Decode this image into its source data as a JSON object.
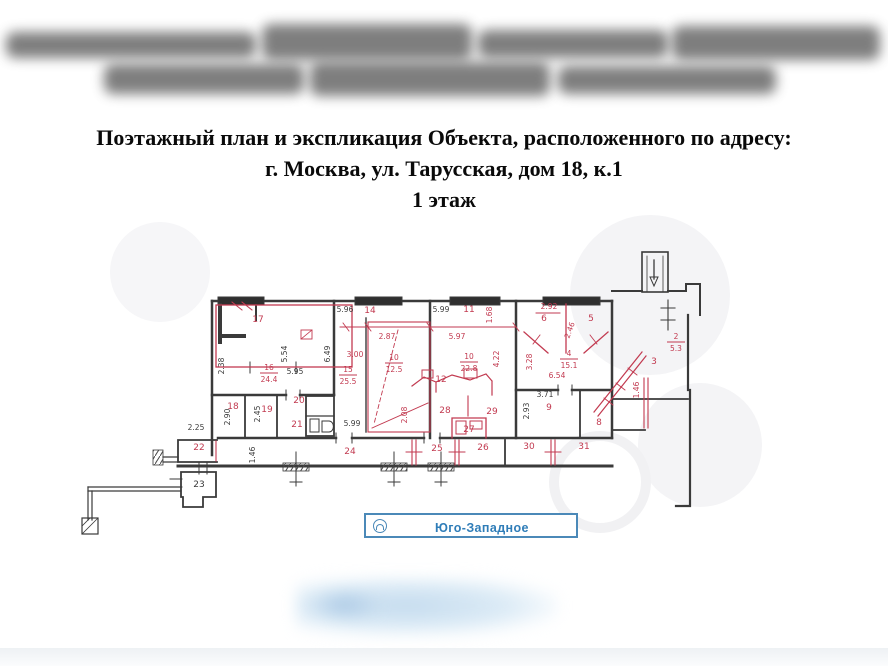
{
  "header": {
    "line1": "Поэтажный план и экспликация Объекта, расположенного по адресу:",
    "line2": "г. Москва, ул. Тарусская, дом 18, к.1",
    "line3": "1 этаж"
  },
  "stamp": {
    "label": "Юго-Западное"
  },
  "plan": {
    "colors": {
      "wall": "#3a3a3a",
      "red": "#c23a50"
    },
    "dims_black": [
      {
        "t": "5.96",
        "x": 345,
        "y": 312
      },
      {
        "t": "5.99",
        "x": 441,
        "y": 312
      },
      {
        "t": "5.54",
        "x": 287,
        "y": 354,
        "v": 1
      },
      {
        "t": "6.49",
        "x": 330,
        "y": 354,
        "v": 1
      },
      {
        "t": "2.38",
        "x": 224,
        "y": 366,
        "v": 1
      },
      {
        "t": "5.95",
        "x": 295,
        "y": 374
      },
      {
        "t": "2.90",
        "x": 230,
        "y": 417,
        "v": 1
      },
      {
        "t": "2.45",
        "x": 260,
        "y": 414,
        "v": 1
      },
      {
        "t": "5.99",
        "x": 352,
        "y": 426
      },
      {
        "t": "2.25",
        "x": 196,
        "y": 430
      },
      {
        "t": "1.46",
        "x": 255,
        "y": 455,
        "v": 1
      },
      {
        "t": "23",
        "x": 199,
        "y": 487,
        "fs": 9
      },
      {
        "t": "3.71",
        "x": 545,
        "y": 397
      },
      {
        "t": "2.93",
        "x": 529,
        "y": 411,
        "v": 1
      }
    ],
    "labels_red": [
      {
        "t": "17",
        "x": 258,
        "y": 322
      },
      {
        "t": "14",
        "x": 370,
        "y": 313
      },
      {
        "t": "11",
        "x": 469,
        "y": 312
      },
      {
        "t": "1.68",
        "x": 492,
        "y": 315,
        "v": 1
      },
      {
        "t": "2.87",
        "x": 387,
        "y": 339
      },
      {
        "t": "3.00",
        "x": 355,
        "y": 357
      },
      {
        "t": "5.97",
        "x": 457,
        "y": 339
      },
      {
        "t": "4.22",
        "x": 499,
        "y": 359,
        "v": 1
      },
      {
        "t": "12",
        "x": 441,
        "y": 382
      },
      {
        "t": "2.92",
        "x": 549,
        "y": 309
      },
      {
        "t": "6",
        "x": 544,
        "y": 321
      },
      {
        "t": "5",
        "x": 591,
        "y": 321
      },
      {
        "t": "2.46",
        "x": 572,
        "y": 331,
        "rot": -70
      },
      {
        "t": "3.28",
        "x": 532,
        "y": 362,
        "v": 1
      },
      {
        "t": "6.54",
        "x": 557,
        "y": 378
      },
      {
        "t": "3",
        "x": 654,
        "y": 364
      },
      {
        "t": "1.46",
        "x": 639,
        "y": 390,
        "v": 1
      },
      {
        "t": "18",
        "x": 233,
        "y": 409
      },
      {
        "t": "19",
        "x": 267,
        "y": 412
      },
      {
        "t": "20",
        "x": 299,
        "y": 403
      },
      {
        "t": "21",
        "x": 297,
        "y": 427
      },
      {
        "t": "22",
        "x": 199,
        "y": 450
      },
      {
        "t": "24",
        "x": 350,
        "y": 454
      },
      {
        "t": "25",
        "x": 437,
        "y": 451
      },
      {
        "t": "26",
        "x": 483,
        "y": 450
      },
      {
        "t": "27",
        "x": 469,
        "y": 432
      },
      {
        "t": "28",
        "x": 445,
        "y": 413
      },
      {
        "t": "29",
        "x": 492,
        "y": 414
      },
      {
        "t": "2.08",
        "x": 407,
        "y": 415,
        "v": 1
      },
      {
        "t": "30",
        "x": 529,
        "y": 449
      },
      {
        "t": "31",
        "x": 584,
        "y": 449
      },
      {
        "t": "9",
        "x": 549,
        "y": 410
      },
      {
        "t": "8",
        "x": 599,
        "y": 425
      }
    ],
    "fractions_red": [
      {
        "n": "16",
        "d": "24.4",
        "x": 269,
        "y": 372
      },
      {
        "n": "15",
        "d": "25.5",
        "x": 348,
        "y": 374
      },
      {
        "n": "10",
        "d": "12.5",
        "x": 394,
        "y": 362
      },
      {
        "n": "10",
        "d": "22.8",
        "x": 469,
        "y": 361
      },
      {
        "n": "4",
        "d": "15.1",
        "x": 569,
        "y": 358
      },
      {
        "n": "2",
        "d": "5.3",
        "x": 676,
        "y": 341
      }
    ]
  }
}
